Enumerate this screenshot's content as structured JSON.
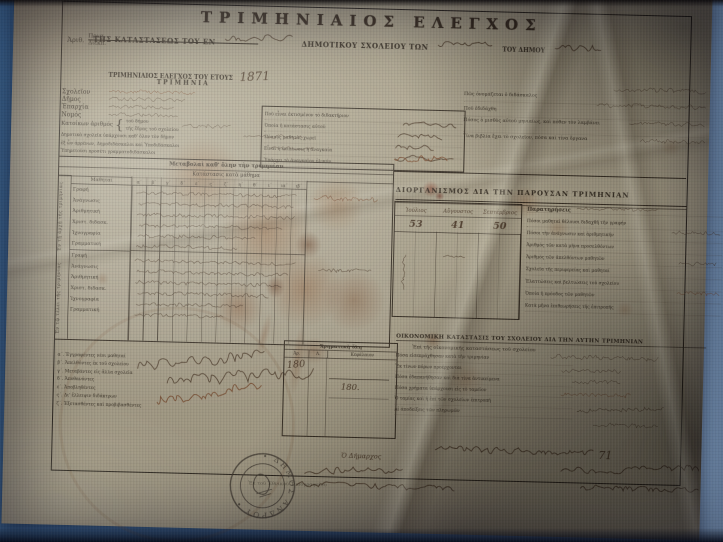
{
  "accent_colors": {
    "screen_blue": "#4a7cae",
    "paper": "#b6ae97",
    "ink": "#2e261c",
    "handwriting": "#4a3726",
    "stain": "#8a4f22"
  },
  "document": {
    "title": "ΤΡΙΜΗΝΙΑΙΟΣ ΕΛΕΓΧΟΣ",
    "subtitle": {
      "pre": "ΤΗΣ ΚΑΤΑΣΤΑΣΕΩΣ ΤΟΥ ΕΝ",
      "mid": "ΔΗΜΟΤΙΚΟΥ ΣΧΟΛΕΙΟΥ ΤΩΝ",
      "post": "ΤΟΥ ΔΗΜΟΥ"
    },
    "protocol": {
      "label": "Ἀριθ.",
      "top": "Πρωτ.",
      "bottom": "Διεκπ."
    },
    "year_line": "ΤΡΙΜΗΝΙΑΙΟΣ ΕΛΕΓΧΟΣ ΤΟΥ ΕΤΟΥΣ",
    "year_value": "1871",
    "trimester_label": "ΤΡΙΜΗΝΙΑ",
    "fields": [
      "Σχολεῖον",
      "Δῆμος",
      "Ἐπαρχία",
      "Νομός"
    ],
    "inhabitants": {
      "label": "Κατοίκων ἀριθμός",
      "sub1": "τοῦ δήμου",
      "sub2": "τῆς ἕδρας τοῦ σχολείου"
    },
    "schools_lines": [
      "Δημοτικὰ σχολεῖα ὑπάρχουσι καθ' ὅλον τὸν δῆμον",
      "ἐξ ὧν ἀρρένων, Δημοδιδάσκαλοι καὶ Ὑποδιδάσκαλοι",
      "Ὑπηρετοῦσι προσέτι γραμματοδιδάσκαλοι"
    ],
    "building_box": {
      "lines": [
        "Ποῦ εἶναι ἐκτισμένον τὸ διδακτήριον",
        "Ὁποία ἡ κατάστασις αὐτοῦ",
        "Πόσους μαθητὰς χωρεῖ",
        "Εἶναι ἡ ἐπίπλωσις ἡ ἀναγκαία",
        "Ὑπάρχει τὸ ἀναγκαῖον ὑλικόν"
      ]
    },
    "teacher": {
      "q1": "Πῶς ὀνομάζεται ὁ διδάσκαλος",
      "q2": "Ποῦ ἐδιδάχθη",
      "q3": "Πόσος ὁ μισθὸς αὐτοῦ μηνιαίως, καὶ πόθεν τὸν λαμβάνει",
      "q4": "Τίνα βιβλία ἔχει τὸ σχολεῖον, πόσα καὶ τίνα ὄργανα"
    },
    "left_table": {
      "title1": "Μεταβολαὶ καθ' ὅλην τὴν τριμηνίαν",
      "title2": "Κατάστασις κατὰ μάθημα",
      "students_label": "Μαθηταί",
      "group1_label": "Ἐν τῇ ἀρχῇ τῆς τριμηνίας",
      "group2_label": "Ἐν τῷ τέλει τῆς τριμηνίας",
      "class_cols": [
        "α΄",
        "β΄",
        "γ΄",
        "δ΄",
        "ε΄",
        "ς΄",
        "ζ΄",
        "η΄",
        "θ΄",
        "ι΄",
        "ια΄",
        "ιβ΄"
      ],
      "subjects": [
        "Γραφή",
        "Ἀνάγνωσις",
        "Ἀριθμητική",
        "Χριστ. διδασκ.",
        "Ἰχνογραφία",
        "Γραμματική"
      ]
    },
    "organization": {
      "heading": "ΔΙΟΡΓΑΝΙΣΜΟΣ ΔΙΑ ΤΗΝ ΠΑΡΟΥΣΑΝ ΤΡΙΜΗΝΙΑΝ",
      "months": [
        "Ἰούλιος",
        "Αὔγουστος",
        "Σεπτέμβριος"
      ],
      "month_values": [
        "53",
        "41",
        "50"
      ]
    },
    "remarks": {
      "heading": "Παρατηρήσεις",
      "lines": [
        "Πόσοι μαθηταὶ θέλουσι διδαχθῆ τὴν γραφήν",
        "Πόσοι τὴν ἀνάγνωσιν καὶ ἀριθμητικήν",
        "Ἀριθμὸς τῶν κατὰ μῆνα προσελθόντων",
        "Ἀριθμὸς τῶν ἀπελθόντων μαθητῶν",
        "Σχολεῖα τῆς περιφερείας καὶ μαθηταί",
        "Ἐλαττώσεις καὶ βελτιώσεις τοῦ σχολείου",
        "Ὁποία ἡ πρόοδος τῶν μαθητῶν",
        "Κατὰ μῆνα ἐπιθεωρήσεις τῆς ἐπιτροπῆς"
      ]
    },
    "economic": {
      "heading": "ΟΙΚΟΝΟΜΙΚΗ ΚΑΤΑΣΤΑΣΙΣ ΤΟΥ ΣΧΟΛΕΙΟΥ ΔΙΑ ΤΗΝ ΑΥΤΗΝ ΤΡΙΜΗΝΙΑΝ",
      "subheading": "Ἐπὶ τῆς οἰκονομικῆς καταστάσεως τοῦ σχολείου",
      "lines": [
        "Πόσα εἰσεπράχθησαν κατὰ τὴν τριμηνίαν",
        "Ἐκ τίνων πόρων προέρχονται",
        "Πόσα ἐδαπανήθησαν καὶ διὰ τίνα ἀντικείμενα",
        "Πόσα χρήματα ὑπάρχουσι εἰς τὸ ταμεῖον",
        "Ὁ ταμίας καὶ ἡ ἐπὶ τῶν σχολείων ἐπιτροπή",
        "Αἱ ἀποδείξεις τῶν πληρωμῶν"
      ]
    },
    "promotion_lines": [
      "α΄. Ἐγγραφέντες νέοι μαθηταί",
      "β΄. Ἀπελθόντες ἐκ τοῦ σχολείου",
      "γ΄. Μεταβάντες εἰς ἄλλα σχολεῖα",
      "δ΄. Ἀποθανόντες",
      "ε΄. Ἀποβληθέντες",
      "ς΄. Δι' ἔλλειψιν διδάκτρων",
      "ζ΄. Ἐξετασθέντες καὶ προβιβασθέντες"
    ],
    "funds_box": {
      "header": "Χρηματικὴ ὕλη",
      "col1": "Ἀρ.",
      "col2": "Λ.",
      "col3": "Κεφάλαιον",
      "value_big": "180",
      "value_small": "180."
    },
    "signature": {
      "mayor": "Ὁ Δήμαρχος",
      "date_year": "71"
    },
    "stamp_text": "• ΔΗΜΟΣ ΑΝΔΡΟΥ •",
    "imprint": "Ἐκ τοῦ Ἐθνικοῦ Τυπογραφείου"
  }
}
